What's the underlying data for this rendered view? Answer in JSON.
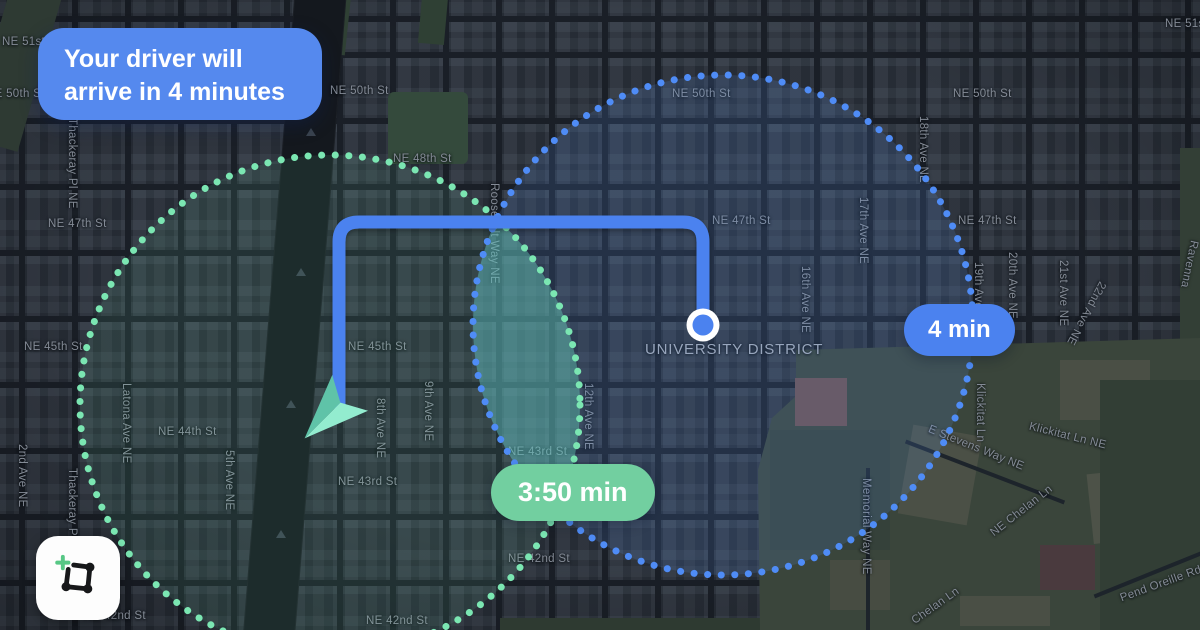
{
  "notification": {
    "line1": "Your driver will",
    "line2": "arrive in 4 minutes"
  },
  "badges": {
    "eta_blue": "4 min",
    "eta_green": "3:50 min"
  },
  "map": {
    "district_label": "UNIVERSITY DISTRICT",
    "street_labels": [
      {
        "t": "NE 51st St",
        "x": 2,
        "y": 36
      },
      {
        "t": "NE 50th St",
        "x": -14,
        "y": 88
      },
      {
        "t": "Thackeray Pl NE",
        "x": 66,
        "y": 118,
        "v": 1
      },
      {
        "t": "NE 47th St",
        "x": 48,
        "y": 218
      },
      {
        "t": "NE 45th St",
        "x": 24,
        "y": 341
      },
      {
        "t": "NE 44th St",
        "x": 158,
        "y": 426
      },
      {
        "t": "Latona Ave NE",
        "x": 120,
        "y": 383,
        "v": 1
      },
      {
        "t": "2nd Ave NE",
        "x": 16,
        "y": 444,
        "v": 1
      },
      {
        "t": "Thackeray Pl NE",
        "x": 66,
        "y": 468,
        "v": 1
      },
      {
        "t": "NE 42nd St",
        "x": 84,
        "y": 610
      },
      {
        "t": "5th Ave NE",
        "x": 223,
        "y": 450,
        "v": 1
      },
      {
        "t": "8th Ave NE",
        "x": 374,
        "y": 398,
        "v": 1
      },
      {
        "t": "9th Ave NE",
        "x": 422,
        "y": 381,
        "v": 1
      },
      {
        "t": "NE 48th St",
        "x": 393,
        "y": 153
      },
      {
        "t": "NE 50th St",
        "x": 330,
        "y": 85
      },
      {
        "t": "Roosevelt Way NE",
        "x": 488,
        "y": 183,
        "v": 1
      },
      {
        "t": "NE 45th St",
        "x": 348,
        "y": 341
      },
      {
        "t": "NE 43rd St",
        "x": 338,
        "y": 476
      },
      {
        "t": "NE 43rd St",
        "x": 508,
        "y": 446
      },
      {
        "t": "NE 42nd St",
        "x": 508,
        "y": 553
      },
      {
        "t": "NE 42nd St",
        "x": 366,
        "y": 615
      },
      {
        "t": "12th Ave NE",
        "x": 582,
        "y": 383,
        "v": 1
      },
      {
        "t": "NE 50th St",
        "x": 672,
        "y": 88
      },
      {
        "t": "NE 47th St",
        "x": 712,
        "y": 215
      },
      {
        "t": "16th Ave NE",
        "x": 799,
        "y": 266,
        "v": 1
      },
      {
        "t": "17th Ave NE",
        "x": 857,
        "y": 197,
        "v": 1
      },
      {
        "t": "18th Ave NE",
        "x": 917,
        "y": 116,
        "v": 1
      },
      {
        "t": "19th Ave NE",
        "x": 972,
        "y": 262,
        "v": 1
      },
      {
        "t": "NE 50th St",
        "x": 953,
        "y": 88
      },
      {
        "t": "NE 51st St",
        "x": 1165,
        "y": 18
      },
      {
        "t": "20th Ave NE",
        "x": 1006,
        "y": 252,
        "v": 1
      },
      {
        "t": "21st Ave NE",
        "x": 1057,
        "y": 260,
        "v": 1
      },
      {
        "t": "22nd Ave NE",
        "x": 1080,
        "y": 278,
        "v": 1,
        "r": 28
      },
      {
        "t": "Ravenna",
        "x": 1183,
        "y": 240,
        "v": 1,
        "r": 12
      },
      {
        "t": "NE 47th St",
        "x": 958,
        "y": 215
      },
      {
        "t": "NE 45th St",
        "x": 948,
        "y": 338
      },
      {
        "t": "Memorial Way NE",
        "x": 860,
        "y": 478,
        "v": 1
      },
      {
        "t": "E Stevens Way NE",
        "x": 925,
        "y": 442,
        "r": 22
      },
      {
        "t": "Klickitat Ln",
        "x": 974,
        "y": 383,
        "v": 1
      },
      {
        "t": "Klickitat Ln NE",
        "x": 1028,
        "y": 430,
        "r": 14
      },
      {
        "t": "NE Chelan Ln",
        "x": 984,
        "y": 505,
        "r": -38
      },
      {
        "t": "Chelan Ln",
        "x": 908,
        "y": 600,
        "r": -35
      },
      {
        "t": "Pend Oreille Rd",
        "x": 1118,
        "y": 578,
        "r": -20
      },
      {
        "t": "UNIVERSITY DISTRICT",
        "x": 645,
        "y": 341,
        "big": 1
      }
    ]
  },
  "icons": {
    "logo": "route-nodes-plus-icon",
    "driver": "navigation-arrow-icon",
    "destination": "location-dot-icon"
  },
  "colors": {
    "notification_blue": "#5589ee",
    "route_blue": "#4b82ef",
    "eta_blue_badge": "#4b82ef",
    "eta_green_badge": "#72cfa0",
    "green_circle_dot": "#7be6b2",
    "blue_circle_dot": "#4f8cf6",
    "driver_arrow_light": "#93eccf",
    "driver_arrow_dark": "#5fc3a8",
    "map_background": "#262c35",
    "campus_green": "#3a453b"
  }
}
